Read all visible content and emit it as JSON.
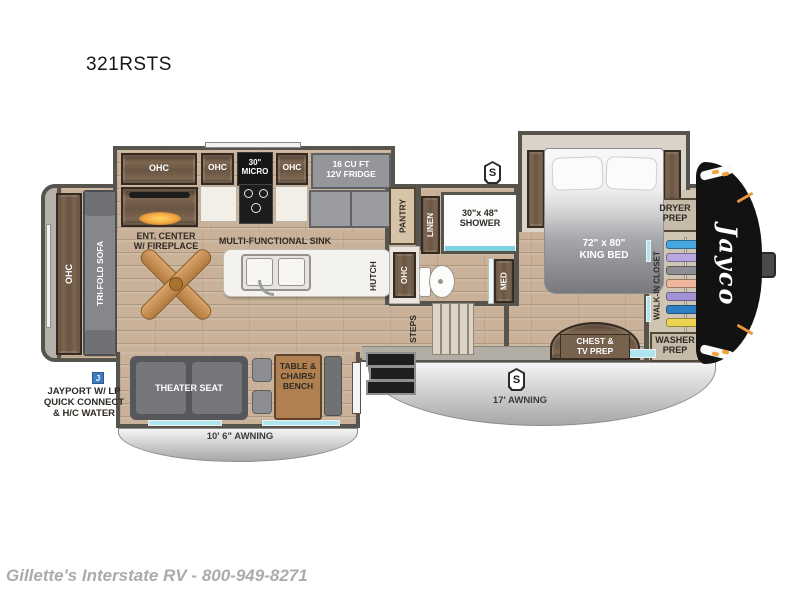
{
  "title": "321RSTS",
  "footer": "Gillette's Interstate RV - 800-949-8271",
  "labels": {
    "ohc": "OHC",
    "tri_fold_sofa": "TRI-FOLD SOFA",
    "ent_center": "ENT. CENTER\nW/ FIREPLACE",
    "micro": "30\"\nMICRO",
    "fridge": "16 CU FT\n12V FRIDGE",
    "multi_sink": "MULTI-FUNCTIONAL SINK",
    "pantry": "PANTRY",
    "linen": "LINEN",
    "hutch": "HUTCH",
    "shower": "30\"x 48\"\nSHOWER",
    "med": "MED",
    "steps": "STEPS",
    "king_bed": "72\" x 80\"\nKING BED",
    "chest_tv": "CHEST &\nTV PREP",
    "dryer_prep": "DRYER\nPREP",
    "walk_in_closet": "WALK-IN CLOSET",
    "washer_prep": "WASHER\nPREP",
    "theater_seat": "THEATER SEAT",
    "table_chairs": "TABLE &\nCHAIRS/\nBENCH",
    "awning_17": "17' AWNING",
    "awning_10": "10' 6\" AWNING",
    "jayport": "JAYPORT W/ LP\nQUICK CONNECT\n& H/C WATER",
    "s_badge": "S",
    "j_badge": "J",
    "brand": "Jayco"
  },
  "closet": {
    "hangers": [
      "#45a6e0",
      "#b7a7e0",
      "#8d8d92",
      "#f2b59d",
      "#a393d6",
      "#2f7fc4",
      "#ead34e"
    ]
  },
  "colors": {
    "wall": "#57534d",
    "floor_wood": "#c9b299",
    "cabinet_wood": "#6a5544",
    "awning_gray": "#c9c9cb",
    "window_teal": "#aee6f0",
    "front_cap_black": "#121212",
    "fireplace_glow": "#f2a33c",
    "jayport_blue": "#3f7dbf"
  }
}
